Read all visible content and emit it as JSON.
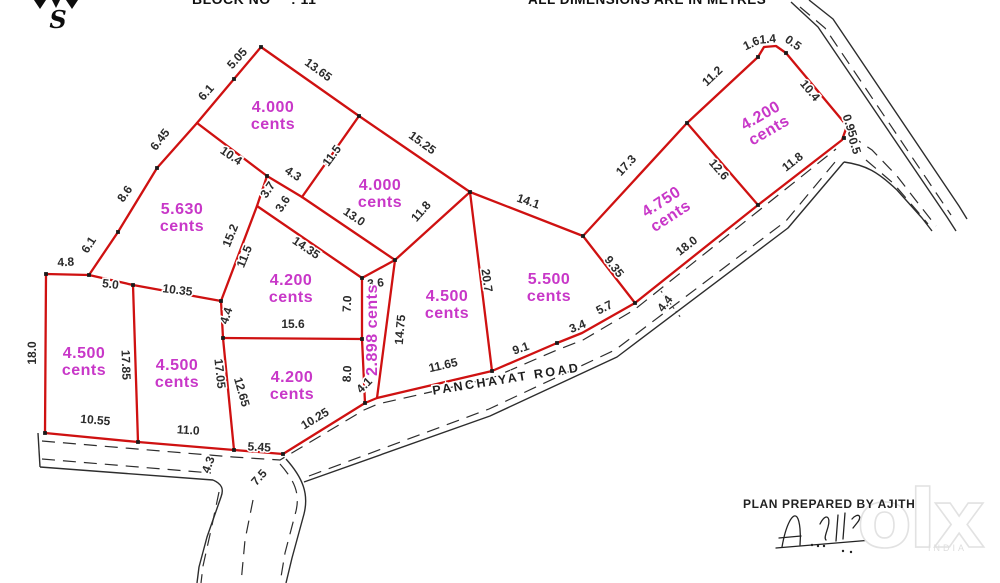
{
  "header": {
    "block_label": "BLOCK NO",
    "block_value": ": 11",
    "dimensions_note": "ALL DIMENSIONS ARE IN METRES",
    "compass_letter": "S"
  },
  "road": {
    "name": "PANCHAYAT ROAD"
  },
  "footer": {
    "prepared_by": "PLAN PREPARED BY AJITH"
  },
  "watermark": {
    "brand": "olx",
    "country": "INDIA"
  },
  "colors": {
    "plot_line": "#cf1111",
    "plot_label": "#c837c8",
    "dimension_text": "#2b2b2b",
    "road_line": "#2d2d2d"
  },
  "plots": [
    {
      "lines": [
        "4.000",
        "cents"
      ],
      "x": 273,
      "y": 112,
      "rot": 0
    },
    {
      "lines": [
        "4.000",
        "cents"
      ],
      "x": 380,
      "y": 190,
      "rot": 0
    },
    {
      "lines": [
        "5.630",
        "cents"
      ],
      "x": 182,
      "y": 214,
      "rot": 0
    },
    {
      "lines": [
        "4.200",
        "cents"
      ],
      "x": 291,
      "y": 285,
      "rot": 0
    },
    {
      "lines": [
        "2.898 cents"
      ],
      "x": 377,
      "y": 330,
      "rot": -90
    },
    {
      "lines": [
        "4.500",
        "cents"
      ],
      "x": 447,
      "y": 301,
      "rot": 0
    },
    {
      "lines": [
        "5.500",
        "cents"
      ],
      "x": 549,
      "y": 284,
      "rot": 0
    },
    {
      "lines": [
        "4.750",
        "cents"
      ],
      "x": 664,
      "y": 206,
      "rot": -33
    },
    {
      "lines": [
        "4.200",
        "cents"
      ],
      "x": 763,
      "y": 120,
      "rot": -30
    },
    {
      "lines": [
        "4.500",
        "cents"
      ],
      "x": 84,
      "y": 358,
      "rot": 0
    },
    {
      "lines": [
        "4.500",
        "cents"
      ],
      "x": 177,
      "y": 370,
      "rot": 0
    },
    {
      "lines": [
        "4.200",
        "cents"
      ],
      "x": 292,
      "y": 382,
      "rot": 0
    }
  ],
  "dimensions": [
    {
      "v": "5.05",
      "x": 240,
      "y": 61,
      "r": -48
    },
    {
      "v": "6.1",
      "x": 209,
      "y": 95,
      "r": -48
    },
    {
      "v": "6.45",
      "x": 163,
      "y": 142,
      "r": -52
    },
    {
      "v": "8.6",
      "x": 128,
      "y": 196,
      "r": -55
    },
    {
      "v": "6.1",
      "x": 92,
      "y": 247,
      "r": -57
    },
    {
      "v": "4.8",
      "x": 66,
      "y": 266,
      "r": -3
    },
    {
      "v": "13.65",
      "x": 316,
      "y": 73,
      "r": 36
    },
    {
      "v": "15.25",
      "x": 420,
      "y": 146,
      "r": 36
    },
    {
      "v": "10.4",
      "x": 229,
      "y": 159,
      "r": 34
    },
    {
      "v": "4.3",
      "x": 291,
      "y": 177,
      "r": 33
    },
    {
      "v": "11.5",
      "x": 335,
      "y": 158,
      "r": -54
    },
    {
      "v": "3.7",
      "x": 271,
      "y": 192,
      "r": -56
    },
    {
      "v": "3.6",
      "x": 286,
      "y": 206,
      "r": -56
    },
    {
      "v": "13.0",
      "x": 352,
      "y": 220,
      "r": 34
    },
    {
      "v": "14.35",
      "x": 304,
      "y": 251,
      "r": 34
    },
    {
      "v": "11.8",
      "x": 424,
      "y": 214,
      "r": -49
    },
    {
      "v": "14.1",
      "x": 527,
      "y": 205,
      "r": 19
    },
    {
      "v": "17.3",
      "x": 629,
      "y": 168,
      "r": -47
    },
    {
      "v": "11.2",
      "x": 715,
      "y": 79,
      "r": -43
    },
    {
      "v": "1.6",
      "x": 753,
      "y": 47,
      "r": -25
    },
    {
      "v": "1.4",
      "x": 768,
      "y": 43,
      "r": -5
    },
    {
      "v": "0.5",
      "x": 791,
      "y": 46,
      "r": 35
    },
    {
      "v": "10.4",
      "x": 807,
      "y": 93,
      "r": 50
    },
    {
      "v": "0.95",
      "x": 846,
      "y": 127,
      "r": 72
    },
    {
      "v": "0.5",
      "x": 851,
      "y": 147,
      "r": 72
    },
    {
      "v": "11.8",
      "x": 795,
      "y": 165,
      "r": -38
    },
    {
      "v": "12.6",
      "x": 716,
      "y": 172,
      "r": 49
    },
    {
      "v": "18.0",
      "x": 689,
      "y": 249,
      "r": -38
    },
    {
      "v": "9.35",
      "x": 611,
      "y": 269,
      "r": 52
    },
    {
      "v": "5.7",
      "x": 606,
      "y": 311,
      "r": -27
    },
    {
      "v": "3.4",
      "x": 579,
      "y": 330,
      "r": -22
    },
    {
      "v": "9.1",
      "x": 522,
      "y": 352,
      "r": -19
    },
    {
      "v": "20.7",
      "x": 483,
      "y": 281,
      "r": 82
    },
    {
      "v": "11.65",
      "x": 444,
      "y": 369,
      "r": -13
    },
    {
      "v": "4.1",
      "x": 367,
      "y": 388,
      "r": -45
    },
    {
      "v": "10.25",
      "x": 317,
      "y": 422,
      "r": -31
    },
    {
      "v": "14.75",
      "x": 404,
      "y": 330,
      "r": -85
    },
    {
      "v": "7.0",
      "x": 351,
      "y": 304,
      "r": -87
    },
    {
      "v": "8.0",
      "x": 351,
      "y": 374,
      "r": -87
    },
    {
      "v": "3.6",
      "x": 376,
      "y": 287,
      "r": -6
    },
    {
      "v": "15.2",
      "x": 234,
      "y": 237,
      "r": -68
    },
    {
      "v": "11.5",
      "x": 248,
      "y": 258,
      "r": -68
    },
    {
      "v": "10.35",
      "x": 177,
      "y": 294,
      "r": 7
    },
    {
      "v": "5.0",
      "x": 110,
      "y": 288,
      "r": 7
    },
    {
      "v": "4.4",
      "x": 230,
      "y": 317,
      "r": -72
    },
    {
      "v": "15.6",
      "x": 293,
      "y": 328,
      "r": 0
    },
    {
      "v": "17.85",
      "x": 122,
      "y": 365,
      "r": 88
    },
    {
      "v": "17.05",
      "x": 216,
      "y": 374,
      "r": 84
    },
    {
      "v": "12.65",
      "x": 238,
      "y": 393,
      "r": 74
    },
    {
      "v": "18.0",
      "x": 36,
      "y": 353,
      "r": -90
    },
    {
      "v": "10.55",
      "x": 95,
      "y": 424,
      "r": 5
    },
    {
      "v": "11.0",
      "x": 188,
      "y": 434,
      "r": 4
    },
    {
      "v": "5.45",
      "x": 259,
      "y": 451,
      "r": 3
    },
    {
      "v": "4.3",
      "x": 212,
      "y": 466,
      "r": -70
    },
    {
      "v": "7.5",
      "x": 262,
      "y": 480,
      "r": -48
    },
    {
      "v": "4.4",
      "x": 668,
      "y": 306,
      "r": -52
    }
  ]
}
